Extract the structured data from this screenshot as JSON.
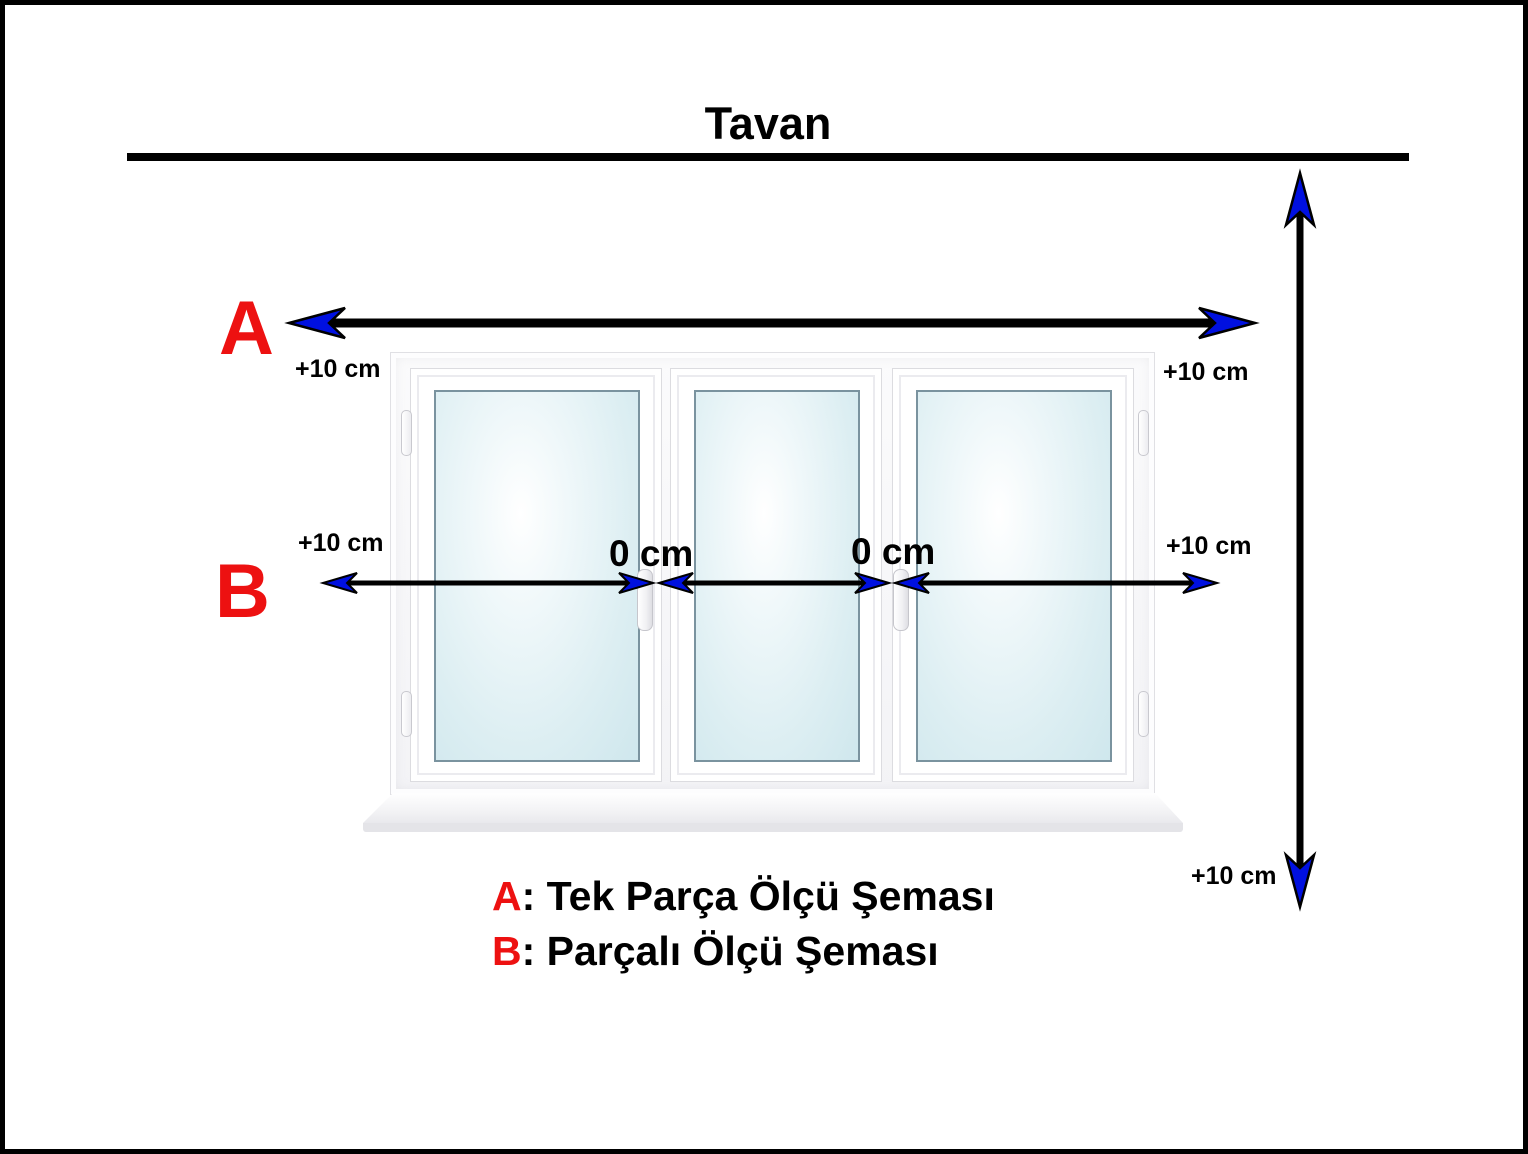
{
  "title": "Tavan",
  "markers": {
    "a": "A",
    "b": "B"
  },
  "measurements": {
    "a_left": "+10 cm",
    "a_right": "+10 cm",
    "b_left": "+10 cm",
    "b_right": "+10 cm",
    "b_gap_1": "0 cm",
    "b_gap_2": "0 cm",
    "height_bottom": "+10 cm"
  },
  "legend": [
    {
      "key": "A",
      "rest": ": Tek Parça Ölçü Şeması"
    },
    {
      "key": "B",
      "rest": ": Parçalı Ölçü Şeması"
    }
  ],
  "colors": {
    "marker_red": "#ed1111",
    "arrowhead_blue": "#0010e0",
    "line_black": "#000000",
    "glass_blue": "#dceef2"
  }
}
